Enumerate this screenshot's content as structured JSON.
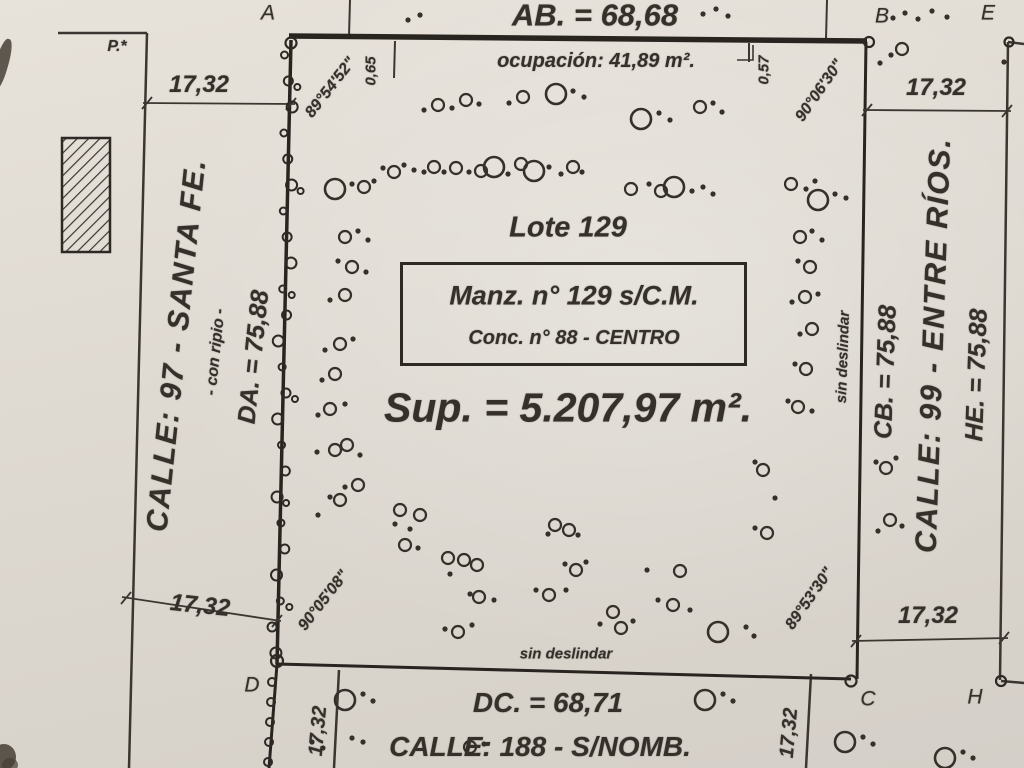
{
  "plan": {
    "top": {
      "ab_label": "AB. = 68,68",
      "ocupacion": "ocupación: 41,89 m².",
      "offset_left": "0,65",
      "offset_right": "0,57",
      "p_label": "P.*"
    },
    "corners": {
      "a": "A",
      "b": "B",
      "e": "E",
      "d": "D",
      "c": "C",
      "h": "H"
    },
    "angles": {
      "a": "89°54'52\"",
      "b": "90°06'30\"",
      "d": "90°05'08\"",
      "c": "89°53'30\""
    },
    "dims": {
      "tl": "17,32",
      "tr": "17,32",
      "bl": "17,32",
      "br": "17,32",
      "cross_left": "17,32",
      "cross_right": "17,32"
    },
    "left_street": {
      "name": "CALLE: 97 - SANTA FE.",
      "surface": "- con ripio -",
      "side_dim": "DA. = 75,88"
    },
    "right_street": {
      "name": "CALLE: 99 - ENTRE RÍOS.",
      "side_dim_left": "CB. = 75,88",
      "side_dim_right": "HE. = 75,88",
      "sin_deslindar": "sin deslindar"
    },
    "bottom_street": {
      "name": "CALLE: 188 - S/NOMB.",
      "dc_label": "DC. = 68,71",
      "sin_deslindar": "sin deslindar"
    },
    "lot": {
      "name": "Lote 129",
      "manz": "Manz. n° 129 s/C.M.",
      "conc": "Conc. n° 88 - CENTRO",
      "sup": "Sup. = 5.207,97 m²."
    },
    "ink": "#332e28",
    "paper": "#e0dbd3",
    "trees": [
      [
        408,
        20,
        "s"
      ],
      [
        420,
        15,
        "s"
      ],
      [
        703,
        14,
        "s"
      ],
      [
        716,
        9,
        "s"
      ],
      [
        728,
        16,
        "s"
      ],
      [
        893,
        18,
        "s"
      ],
      [
        905,
        13,
        "s"
      ],
      [
        918,
        19,
        "s"
      ],
      [
        932,
        11,
        "s"
      ],
      [
        947,
        17,
        "s"
      ],
      [
        891,
        55,
        "s"
      ],
      [
        902,
        49,
        "m"
      ],
      [
        880,
        63,
        "s"
      ],
      [
        1004,
        62,
        "s"
      ],
      [
        424,
        110,
        "s"
      ],
      [
        438,
        105,
        "m"
      ],
      [
        452,
        108,
        "s"
      ],
      [
        466,
        100,
        "m"
      ],
      [
        479,
        104,
        "s"
      ],
      [
        509,
        103,
        "s"
      ],
      [
        523,
        97,
        "m"
      ],
      [
        556,
        94,
        "l"
      ],
      [
        573,
        91,
        "s"
      ],
      [
        584,
        97,
        "s"
      ],
      [
        641,
        119,
        "l"
      ],
      [
        659,
        113,
        "s"
      ],
      [
        670,
        120,
        "s"
      ],
      [
        700,
        107,
        "m"
      ],
      [
        713,
        103,
        "s"
      ],
      [
        722,
        112,
        "s"
      ],
      [
        335,
        189,
        "l"
      ],
      [
        352,
        184,
        "s"
      ],
      [
        364,
        187,
        "m"
      ],
      [
        374,
        181,
        "s"
      ],
      [
        383,
        168,
        "s"
      ],
      [
        394,
        172,
        "m"
      ],
      [
        404,
        165,
        "s"
      ],
      [
        414,
        170,
        "s"
      ],
      [
        424,
        172,
        "s"
      ],
      [
        434,
        167,
        "m"
      ],
      [
        444,
        172,
        "s"
      ],
      [
        456,
        168,
        "m"
      ],
      [
        469,
        172,
        "s"
      ],
      [
        481,
        171,
        "m"
      ],
      [
        494,
        167,
        "l"
      ],
      [
        508,
        174,
        "s"
      ],
      [
        521,
        164,
        "m"
      ],
      [
        534,
        171,
        "l"
      ],
      [
        549,
        167,
        "s"
      ],
      [
        561,
        174,
        "s"
      ],
      [
        573,
        167,
        "m"
      ],
      [
        582,
        172,
        "s"
      ],
      [
        631,
        189,
        "m"
      ],
      [
        649,
        184,
        "s"
      ],
      [
        661,
        191,
        "m"
      ],
      [
        674,
        187,
        "l"
      ],
      [
        692,
        191,
        "s"
      ],
      [
        703,
        187,
        "s"
      ],
      [
        713,
        194,
        "s"
      ],
      [
        791,
        184,
        "m"
      ],
      [
        806,
        189,
        "s"
      ],
      [
        815,
        181,
        "s"
      ],
      [
        818,
        200,
        "l"
      ],
      [
        835,
        194,
        "s"
      ],
      [
        846,
        198,
        "s"
      ],
      [
        345,
        237,
        "m"
      ],
      [
        358,
        231,
        "s"
      ],
      [
        368,
        240,
        "s"
      ],
      [
        352,
        267,
        "m"
      ],
      [
        338,
        261,
        "s"
      ],
      [
        366,
        272,
        "s"
      ],
      [
        345,
        295,
        "m"
      ],
      [
        330,
        300,
        "s"
      ],
      [
        340,
        344,
        "m"
      ],
      [
        353,
        339,
        "s"
      ],
      [
        325,
        350,
        "s"
      ],
      [
        335,
        374,
        "m"
      ],
      [
        322,
        380,
        "s"
      ],
      [
        330,
        409,
        "m"
      ],
      [
        345,
        404,
        "s"
      ],
      [
        318,
        415,
        "s"
      ],
      [
        335,
        450,
        "m"
      ],
      [
        347,
        445,
        "m"
      ],
      [
        360,
        455,
        "s"
      ],
      [
        317,
        452,
        "s"
      ],
      [
        358,
        485,
        "m"
      ],
      [
        345,
        487,
        "s"
      ],
      [
        340,
        500,
        "m"
      ],
      [
        330,
        497,
        "s"
      ],
      [
        318,
        515,
        "s"
      ],
      [
        800,
        237,
        "m"
      ],
      [
        812,
        231,
        "s"
      ],
      [
        822,
        240,
        "s"
      ],
      [
        810,
        267,
        "m"
      ],
      [
        798,
        261,
        "s"
      ],
      [
        805,
        297,
        "m"
      ],
      [
        818,
        294,
        "s"
      ],
      [
        792,
        302,
        "s"
      ],
      [
        812,
        329,
        "m"
      ],
      [
        800,
        334,
        "s"
      ],
      [
        795,
        364,
        "s"
      ],
      [
        806,
        369,
        "m"
      ],
      [
        798,
        407,
        "m"
      ],
      [
        812,
        411,
        "s"
      ],
      [
        788,
        401,
        "s"
      ],
      [
        763,
        470,
        "m"
      ],
      [
        755,
        462,
        "s"
      ],
      [
        767,
        533,
        "m"
      ],
      [
        755,
        528,
        "s"
      ],
      [
        775,
        498,
        "s"
      ],
      [
        876,
        462,
        "s"
      ],
      [
        886,
        468,
        "m"
      ],
      [
        896,
        458,
        "s"
      ],
      [
        890,
        520,
        "m"
      ],
      [
        902,
        526,
        "s"
      ],
      [
        878,
        531,
        "s"
      ],
      [
        400,
        510,
        "m"
      ],
      [
        420,
        515,
        "m"
      ],
      [
        410,
        529,
        "s"
      ],
      [
        395,
        524,
        "s"
      ],
      [
        405,
        545,
        "m"
      ],
      [
        418,
        548,
        "s"
      ],
      [
        448,
        558,
        "m"
      ],
      [
        464,
        560,
        "m"
      ],
      [
        477,
        565,
        "m"
      ],
      [
        450,
        574,
        "s"
      ],
      [
        470,
        594,
        "s"
      ],
      [
        479,
        597,
        "m"
      ],
      [
        494,
        600,
        "s"
      ],
      [
        445,
        629,
        "s"
      ],
      [
        458,
        632,
        "m"
      ],
      [
        472,
        625,
        "s"
      ],
      [
        555,
        525,
        "m"
      ],
      [
        569,
        530,
        "m"
      ],
      [
        578,
        535,
        "s"
      ],
      [
        548,
        534,
        "s"
      ],
      [
        565,
        564,
        "s"
      ],
      [
        576,
        570,
        "m"
      ],
      [
        586,
        562,
        "s"
      ],
      [
        536,
        590,
        "s"
      ],
      [
        549,
        595,
        "m"
      ],
      [
        566,
        590,
        "s"
      ],
      [
        613,
        612,
        "m"
      ],
      [
        600,
        624,
        "s"
      ],
      [
        621,
        628,
        "m"
      ],
      [
        633,
        621,
        "s"
      ],
      [
        647,
        570,
        "s"
      ],
      [
        680,
        571,
        "m"
      ],
      [
        658,
        600,
        "s"
      ],
      [
        673,
        605,
        "m"
      ],
      [
        690,
        610,
        "s"
      ],
      [
        718,
        632,
        "l"
      ],
      [
        746,
        627,
        "s"
      ],
      [
        754,
        636,
        "s"
      ],
      [
        345,
        700,
        "l"
      ],
      [
        363,
        694,
        "s"
      ],
      [
        373,
        701,
        "s"
      ],
      [
        312,
        742,
        "s"
      ],
      [
        323,
        748,
        "s"
      ],
      [
        352,
        738,
        "s"
      ],
      [
        363,
        742,
        "s"
      ],
      [
        470,
        747,
        "m"
      ],
      [
        484,
        744,
        "s"
      ],
      [
        705,
        700,
        "l"
      ],
      [
        723,
        694,
        "s"
      ],
      [
        733,
        701,
        "s"
      ],
      [
        845,
        742,
        "l"
      ],
      [
        863,
        737,
        "s"
      ],
      [
        873,
        744,
        "s"
      ],
      [
        945,
        758,
        "l"
      ],
      [
        963,
        752,
        "s"
      ],
      [
        973,
        758,
        "s"
      ]
    ]
  }
}
